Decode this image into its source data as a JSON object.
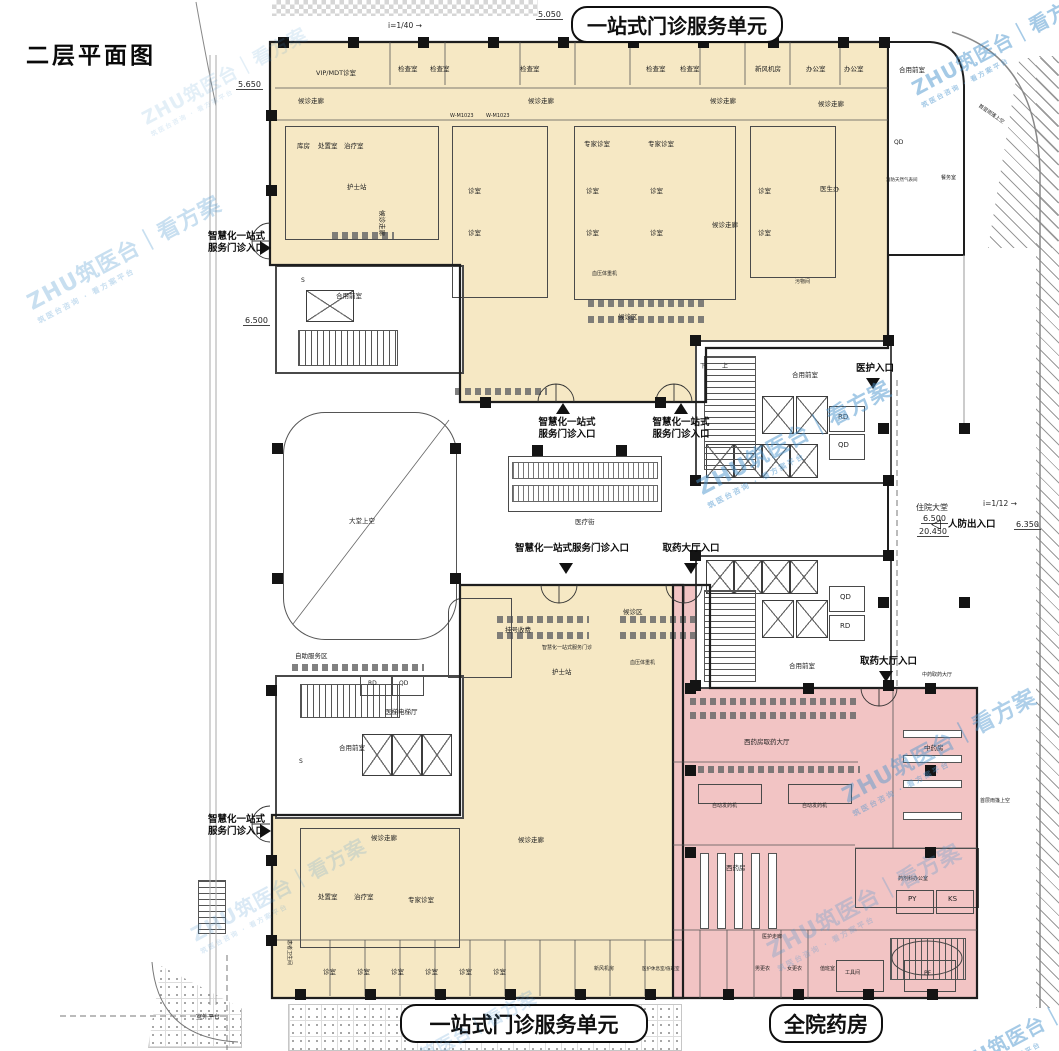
{
  "page": {
    "plan_title": "二层平面图"
  },
  "banners": {
    "top": "一站式门诊服务单元",
    "bottom": "一站式门诊服务单元",
    "pharmacy": "全院药房"
  },
  "watermark": {
    "brand": "ZHU筑医台｜看方案",
    "sub": "筑医台咨询 · 看方案平台"
  },
  "colors": {
    "cream": "#f6e8c4",
    "pink": "#f2c4c4",
    "ink": "#1d1d1d",
    "watermark_blue": "#4d96cf"
  },
  "watermarks": [
    {
      "x": 18,
      "y": 235,
      "o": 0.3,
      "s": 1
    },
    {
      "x": 118,
      "y": 58,
      "o": 0.15,
      "s": 0.85
    },
    {
      "x": 893,
      "y": 26,
      "o": 0.5,
      "s": 0.9
    },
    {
      "x": 688,
      "y": 420,
      "o": 0.5,
      "s": 1
    },
    {
      "x": 833,
      "y": 728,
      "o": 0.45,
      "s": 1
    },
    {
      "x": 758,
      "y": 883,
      "o": 0.28,
      "s": 1
    },
    {
      "x": 172,
      "y": 872,
      "o": 0.2,
      "s": 0.9
    },
    {
      "x": 925,
      "y": 1010,
      "o": 0.5,
      "s": 0.9
    },
    {
      "x": 352,
      "y": 1018,
      "o": 0.22,
      "s": 0.8
    }
  ],
  "entrances": [
    {
      "label": "智慧化一站式\n服务门诊入口",
      "x": 193,
      "y": 231,
      "w": 72,
      "align": "right",
      "tri": "right",
      "tx": 260,
      "ty": 241
    },
    {
      "label": "智慧化一站式\n服务门诊入口",
      "x": 193,
      "y": 814,
      "w": 72,
      "align": "right",
      "tri": "right",
      "tx": 260,
      "ty": 824
    },
    {
      "label": "智慧化一站式\n服务门诊入口",
      "x": 527,
      "y": 417,
      "w": 80,
      "align": "center",
      "tri": "up",
      "tx": 556,
      "ty": 403
    },
    {
      "label": "智慧化一站式\n服务门诊入口",
      "x": 641,
      "y": 417,
      "w": 80,
      "align": "center",
      "tri": "up",
      "tx": 674,
      "ty": 403
    },
    {
      "label": "智慧化一站式服务门诊入口",
      "x": 506,
      "y": 543,
      "w": 132,
      "align": "center",
      "tri": "down",
      "tx": 559,
      "ty": 563
    },
    {
      "label": "取药大厅入口",
      "x": 655,
      "y": 543,
      "w": 72,
      "align": "center",
      "tri": "down",
      "tx": 684,
      "ty": 563
    },
    {
      "label": "取药大厅入口",
      "x": 860,
      "y": 656,
      "w": 72,
      "align": "left",
      "tri": "down",
      "tx": 879,
      "ty": 671
    },
    {
      "label": "医护入口",
      "x": 856,
      "y": 363,
      "w": 50,
      "align": "left",
      "tri": "down",
      "tx": 866,
      "ty": 378
    },
    {
      "label": "人防出入口",
      "x": 948,
      "y": 519,
      "w": 60,
      "align": "left",
      "tri": "hollow-left",
      "tx": 931,
      "ty": 518
    }
  ],
  "elevations": [
    {
      "text": "5.050",
      "x": 536,
      "y": 10
    },
    {
      "text": "5.650",
      "x": 236,
      "y": 80
    },
    {
      "text": "6.500",
      "x": 243,
      "y": 316
    },
    {
      "text": "6.350",
      "x": 1014,
      "y": 520
    },
    {
      "text": "住院大堂",
      "x": 914,
      "y": 502
    },
    {
      "text": "6.500",
      "x": 921,
      "y": 514
    },
    {
      "text": "20.450",
      "x": 917,
      "y": 527
    }
  ],
  "slopes": [
    {
      "text": "i=1/40",
      "x": 388,
      "y": 21
    },
    {
      "text": "i=1/12",
      "x": 983,
      "y": 499
    }
  ],
  "rooms": [
    {
      "t": "VIP/MDT诊室",
      "x": 316,
      "y": 70
    },
    {
      "t": "检查室",
      "x": 398,
      "y": 66
    },
    {
      "t": "检查室",
      "x": 430,
      "y": 66
    },
    {
      "t": "检查室",
      "x": 520,
      "y": 66
    },
    {
      "t": "检查室",
      "x": 646,
      "y": 66
    },
    {
      "t": "检查室",
      "x": 680,
      "y": 66
    },
    {
      "t": "新风机房",
      "x": 755,
      "y": 66
    },
    {
      "t": "办公室",
      "x": 806,
      "y": 66
    },
    {
      "t": "办公室",
      "x": 844,
      "y": 66
    },
    {
      "t": "候诊走廊",
      "x": 298,
      "y": 98
    },
    {
      "t": "候诊走廊",
      "x": 528,
      "y": 98
    },
    {
      "t": "候诊走廊",
      "x": 710,
      "y": 98
    },
    {
      "t": "候诊走廊",
      "x": 818,
      "y": 101
    },
    {
      "t": "W-M1023",
      "x": 450,
      "y": 114,
      "fs": 5
    },
    {
      "t": "W-M1023",
      "x": 486,
      "y": 114,
      "fs": 5
    },
    {
      "t": "库房",
      "x": 297,
      "y": 143
    },
    {
      "t": "处置室",
      "x": 318,
      "y": 143
    },
    {
      "t": "治疗室",
      "x": 344,
      "y": 143
    },
    {
      "t": "专家诊室",
      "x": 584,
      "y": 141
    },
    {
      "t": "专家诊室",
      "x": 648,
      "y": 141
    },
    {
      "t": "护士站",
      "x": 347,
      "y": 184
    },
    {
      "t": "医生办",
      "x": 820,
      "y": 186
    },
    {
      "t": "诊室",
      "x": 468,
      "y": 188
    },
    {
      "t": "诊室",
      "x": 468,
      "y": 230
    },
    {
      "t": "诊室",
      "x": 586,
      "y": 188
    },
    {
      "t": "诊室",
      "x": 650,
      "y": 188
    },
    {
      "t": "诊室",
      "x": 586,
      "y": 230
    },
    {
      "t": "诊室",
      "x": 650,
      "y": 230
    },
    {
      "t": "血压体重机",
      "x": 592,
      "y": 272,
      "fs": 5
    },
    {
      "t": "诊室",
      "x": 758,
      "y": 188
    },
    {
      "t": "诊室",
      "x": 758,
      "y": 230
    },
    {
      "t": "候诊走廊",
      "x": 385,
      "y": 210,
      "rot": 90
    },
    {
      "t": "候诊走廊",
      "x": 712,
      "y": 222
    },
    {
      "t": "污物间",
      "x": 795,
      "y": 280,
      "fs": 5
    },
    {
      "t": "候诊区",
      "x": 618,
      "y": 314
    },
    {
      "t": "S",
      "x": 301,
      "y": 278,
      "fs": 6
    },
    {
      "t": "合用前室",
      "x": 336,
      "y": 293
    },
    {
      "t": "下",
      "x": 700,
      "y": 364,
      "fs": 6
    },
    {
      "t": "上",
      "x": 722,
      "y": 364,
      "fs": 6
    },
    {
      "t": "合用前室",
      "x": 792,
      "y": 372
    },
    {
      "t": "RD",
      "x": 838,
      "y": 413,
      "fs": 7
    },
    {
      "t": "QD",
      "x": 838,
      "y": 441,
      "fs": 7
    },
    {
      "t": "QD",
      "x": 840,
      "y": 593,
      "fs": 7
    },
    {
      "t": "RD",
      "x": 840,
      "y": 622,
      "fs": 7
    },
    {
      "t": "合用前室",
      "x": 789,
      "y": 663
    },
    {
      "t": "合用前室",
      "x": 899,
      "y": 67
    },
    {
      "t": "QD",
      "x": 894,
      "y": 140,
      "fs": 6
    },
    {
      "t": "餐务室",
      "x": 941,
      "y": 176,
      "fs": 5
    },
    {
      "t": "消防天然气表间",
      "x": 886,
      "y": 178,
      "fs": 4.5
    },
    {
      "t": "大堂上空",
      "x": 349,
      "y": 518
    },
    {
      "t": "医疗街",
      "x": 575,
      "y": 519
    },
    {
      "t": "自助服务区",
      "x": 295,
      "y": 653
    },
    {
      "t": "医梯电梯厅",
      "x": 385,
      "y": 709
    },
    {
      "t": "合用前室",
      "x": 339,
      "y": 745
    },
    {
      "t": "S",
      "x": 299,
      "y": 759,
      "fs": 6
    },
    {
      "t": "RD",
      "x": 368,
      "y": 681,
      "fs": 6
    },
    {
      "t": "QD",
      "x": 399,
      "y": 681,
      "fs": 6
    },
    {
      "t": "挂号收费",
      "x": 505,
      "y": 627
    },
    {
      "t": "智慧化一站式服务门诊",
      "x": 542,
      "y": 646,
      "fs": 5
    },
    {
      "t": "护士站",
      "x": 552,
      "y": 669
    },
    {
      "t": "血压体重机",
      "x": 630,
      "y": 661,
      "fs": 5
    },
    {
      "t": "候诊区",
      "x": 623,
      "y": 609
    },
    {
      "t": "候诊走廊",
      "x": 371,
      "y": 835
    },
    {
      "t": "候诊走廊",
      "x": 518,
      "y": 837
    },
    {
      "t": "处置室",
      "x": 318,
      "y": 894
    },
    {
      "t": "治疗室",
      "x": 354,
      "y": 894
    },
    {
      "t": "专家诊室",
      "x": 408,
      "y": 897
    },
    {
      "t": "患者卫生间",
      "x": 291,
      "y": 940,
      "fs": 5,
      "rot": 90
    },
    {
      "t": "诊室",
      "x": 323,
      "y": 969
    },
    {
      "t": "诊室",
      "x": 357,
      "y": 969
    },
    {
      "t": "诊室",
      "x": 391,
      "y": 969
    },
    {
      "t": "诊室",
      "x": 425,
      "y": 969
    },
    {
      "t": "诊室",
      "x": 459,
      "y": 969
    },
    {
      "t": "诊室",
      "x": 493,
      "y": 969
    },
    {
      "t": "新风机房",
      "x": 594,
      "y": 967,
      "fs": 5
    },
    {
      "t": "医护休息室/值班室",
      "x": 642,
      "y": 967,
      "fs": 4.5
    },
    {
      "t": "西药房取药大厅",
      "x": 744,
      "y": 739
    },
    {
      "t": "中药房",
      "x": 924,
      "y": 745
    },
    {
      "t": "自动发药机",
      "x": 712,
      "y": 804,
      "fs": 5
    },
    {
      "t": "自动发药机",
      "x": 802,
      "y": 804,
      "fs": 5
    },
    {
      "t": "西药房",
      "x": 726,
      "y": 865
    },
    {
      "t": "药剂科办公室",
      "x": 898,
      "y": 877,
      "fs": 5
    },
    {
      "t": "PY",
      "x": 908,
      "y": 895,
      "fs": 7
    },
    {
      "t": "KS",
      "x": 948,
      "y": 895,
      "fs": 7
    },
    {
      "t": "医护走廊",
      "x": 762,
      "y": 935,
      "fs": 5
    },
    {
      "t": "男更衣",
      "x": 755,
      "y": 967,
      "fs": 5
    },
    {
      "t": "女更衣",
      "x": 787,
      "y": 967,
      "fs": 5
    },
    {
      "t": "值班室",
      "x": 820,
      "y": 967,
      "fs": 5
    },
    {
      "t": "工具间",
      "x": 845,
      "y": 971,
      "fs": 5
    },
    {
      "t": "PF",
      "x": 924,
      "y": 971,
      "fs": 6
    },
    {
      "t": "中药取药大厅",
      "x": 922,
      "y": 673,
      "fs": 5
    },
    {
      "t": "首层雨篷上空",
      "x": 980,
      "y": 104,
      "fs": 5,
      "rot": 35
    },
    {
      "t": "首层雨篷上空",
      "x": 980,
      "y": 799,
      "fs": 5
    },
    {
      "t": "室外平台",
      "x": 196,
      "y": 1015,
      "fs": 6
    }
  ]
}
